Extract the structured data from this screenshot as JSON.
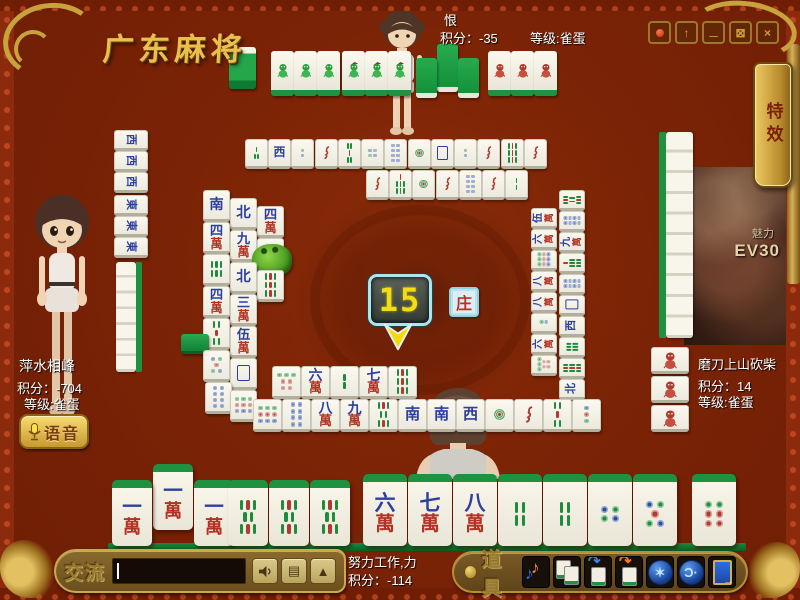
{
  "title": "广东麻将",
  "window_controls": [
    "record",
    "upload",
    "minimize",
    "maximize",
    "close"
  ],
  "effects_tab": "特效",
  "players": {
    "top": {
      "name": "恨",
      "score": "积分：-35",
      "level": "等级:雀蛋"
    },
    "left": {
      "name": "萍水相峰",
      "score": "积分：-704",
      "level": "等级:雀蛋"
    },
    "right": {
      "name": "磨刀上山砍柴",
      "score": "积分：14",
      "level": "等级:雀蛋"
    },
    "bottom": {
      "name": "努力工作,力",
      "score": "积分：-114"
    }
  },
  "voice_button": "语音",
  "chat": {
    "label": "交流",
    "input_value": "",
    "buttons": [
      "speaker",
      "memo",
      "collapse"
    ]
  },
  "props": {
    "label": "道具",
    "icons": [
      "music",
      "tiles",
      "swap-blue",
      "swap-orange",
      "skill",
      "listen",
      "exit"
    ]
  },
  "center": {
    "timer": "15",
    "dealer": "庄"
  },
  "ev_panel": {
    "caption": "魅力",
    "code": "EV30"
  },
  "colors": {
    "table": "#7b2306",
    "gold": "#d7af4a",
    "tile_green": "#1f9242",
    "timer_digits": "#f2dc12",
    "wan_red": "#b23324",
    "char_blue": "#2e3f9f"
  },
  "tiles": [
    [
      229,
      47,
      27,
      42,
      "back",
      "upb",
      0
    ],
    [
      271,
      51,
      23,
      45,
      "sg",
      "up",
      0
    ],
    [
      294,
      51,
      23,
      45,
      "sg",
      "up",
      0
    ],
    [
      317,
      51,
      23,
      45,
      "sg",
      "up",
      0
    ],
    [
      342,
      51,
      23,
      45,
      "sh",
      "up",
      0
    ],
    [
      365,
      51,
      23,
      45,
      "sh",
      "up",
      0
    ],
    [
      388,
      51,
      23,
      45,
      "sh",
      "up",
      0
    ],
    [
      416,
      58,
      21,
      40,
      "",
      "kong",
      0
    ],
    [
      437,
      44,
      21,
      48,
      "",
      "kong",
      0
    ],
    [
      458,
      58,
      21,
      40,
      "",
      "kong",
      0
    ],
    [
      488,
      51,
      23,
      45,
      "sr",
      "up",
      0
    ],
    [
      511,
      51,
      23,
      45,
      "sr",
      "up",
      0
    ],
    [
      534,
      51,
      23,
      45,
      "sr",
      "up",
      0
    ],
    [
      245,
      139,
      23,
      30,
      "b3",
      "flat",
      0
    ],
    [
      268,
      139,
      23,
      30,
      "west",
      "flat",
      0
    ],
    [
      291,
      139,
      23,
      30,
      "c2",
      "flat",
      0
    ],
    [
      315,
      139,
      23,
      30,
      "b1",
      "flat",
      0
    ],
    [
      338,
      139,
      23,
      30,
      "b5",
      "flat",
      0
    ],
    [
      361,
      139,
      23,
      30,
      "c4",
      "flat",
      0
    ],
    [
      384,
      139,
      23,
      30,
      "c8",
      "flat",
      0
    ],
    [
      408,
      139,
      23,
      30,
      "c1",
      "flat",
      0
    ],
    [
      431,
      139,
      23,
      30,
      "white",
      "flat",
      0
    ],
    [
      454,
      139,
      23,
      30,
      "c2",
      "flat",
      0
    ],
    [
      477,
      139,
      23,
      30,
      "b1",
      "flat",
      0
    ],
    [
      501,
      139,
      23,
      30,
      "b9",
      "flat",
      0
    ],
    [
      524,
      139,
      23,
      30,
      "b1",
      "flat",
      0
    ],
    [
      366,
      170,
      23,
      30,
      "b1",
      "flat",
      0
    ],
    [
      389,
      170,
      23,
      30,
      "b7",
      "flat",
      0
    ],
    [
      412,
      170,
      23,
      30,
      "c1",
      "flat",
      0
    ],
    [
      436,
      170,
      23,
      30,
      "b1",
      "flat",
      0
    ],
    [
      459,
      170,
      23,
      30,
      "c8",
      "flat",
      0
    ],
    [
      482,
      170,
      23,
      30,
      "b1",
      "flat",
      0
    ],
    [
      505,
      170,
      23,
      30,
      "b2",
      "flat",
      0
    ],
    [
      114,
      130,
      34,
      21,
      "west",
      "flatL",
      0
    ],
    [
      114,
      151,
      34,
      21,
      "west",
      "flatL",
      0
    ],
    [
      114,
      172,
      34,
      21,
      "west",
      "flatL",
      0
    ],
    [
      114,
      195,
      34,
      21,
      "east",
      "flatL",
      0
    ],
    [
      114,
      216,
      34,
      21,
      "east",
      "flatL",
      0
    ],
    [
      114,
      237,
      34,
      21,
      "east",
      "flatL",
      0
    ],
    [
      181,
      334,
      28,
      20,
      "",
      "backflat",
      0
    ],
    [
      203,
      190,
      27,
      32,
      "south",
      "flat",
      0
    ],
    [
      203,
      222,
      27,
      32,
      "w4",
      "flat",
      0
    ],
    [
      203,
      254,
      27,
      32,
      "b6",
      "flat",
      0
    ],
    [
      203,
      286,
      27,
      32,
      "w4",
      "flat",
      0
    ],
    [
      203,
      318,
      27,
      32,
      "b5",
      "flat",
      0
    ],
    [
      203,
      350,
      27,
      32,
      "c5",
      "flat",
      0
    ],
    [
      205,
      382,
      27,
      32,
      "c8",
      "flat",
      0
    ],
    [
      230,
      198,
      27,
      32,
      "north",
      "flat",
      0
    ],
    [
      230,
      230,
      27,
      32,
      "w9",
      "flat",
      0
    ],
    [
      230,
      262,
      27,
      32,
      "north",
      "flat",
      0
    ],
    [
      230,
      294,
      27,
      32,
      "w3",
      "flat",
      0
    ],
    [
      230,
      326,
      27,
      32,
      "w5",
      "flat",
      0
    ],
    [
      230,
      358,
      27,
      32,
      "white",
      "flat",
      0
    ],
    [
      230,
      390,
      27,
      32,
      "c9",
      "flat",
      0
    ],
    [
      257,
      206,
      27,
      32,
      "w4",
      "flat",
      0
    ],
    [
      257,
      238,
      27,
      32,
      "c6",
      "flat",
      0
    ],
    [
      257,
      270,
      27,
      32,
      "b9",
      "flat",
      0
    ],
    [
      252,
      244,
      40,
      32,
      "",
      "frog",
      0
    ],
    [
      531,
      208,
      26,
      21,
      "w5",
      "flatR",
      0
    ],
    [
      531,
      229,
      26,
      21,
      "w6",
      "flatR",
      0
    ],
    [
      531,
      250,
      26,
      21,
      "c9",
      "flatR",
      0
    ],
    [
      531,
      271,
      26,
      21,
      "w8",
      "flatR",
      0
    ],
    [
      531,
      292,
      26,
      21,
      "w8",
      "flatR",
      0
    ],
    [
      531,
      313,
      26,
      21,
      "c2",
      "flatR",
      0
    ],
    [
      531,
      334,
      26,
      21,
      "w6",
      "flatR",
      0
    ],
    [
      531,
      355,
      26,
      21,
      "c7",
      "flatR",
      0
    ],
    [
      559,
      190,
      26,
      21,
      "b8",
      "flatR",
      0
    ],
    [
      559,
      211,
      26,
      21,
      "c8",
      "flatR",
      0
    ],
    [
      559,
      232,
      26,
      21,
      "w9",
      "flatR",
      0
    ],
    [
      559,
      253,
      26,
      21,
      "b7",
      "flatR",
      0
    ],
    [
      559,
      274,
      26,
      21,
      "c8",
      "flatR",
      0
    ],
    [
      559,
      295,
      26,
      21,
      "white",
      "flatR",
      0
    ],
    [
      559,
      316,
      26,
      21,
      "west",
      "flatR",
      0
    ],
    [
      559,
      337,
      26,
      21,
      "b6",
      "flatR",
      0
    ],
    [
      559,
      358,
      26,
      21,
      "b9",
      "flatR",
      0
    ],
    [
      559,
      379,
      26,
      21,
      "north",
      "flatR",
      0
    ],
    [
      651,
      347,
      38,
      27,
      "sr",
      "flat",
      0
    ],
    [
      651,
      376,
      38,
      27,
      "sr",
      "flat",
      0
    ],
    [
      651,
      405,
      38,
      27,
      "sr",
      "flat",
      0
    ],
    [
      112,
      480,
      40,
      66,
      "w1",
      "stand",
      0
    ],
    [
      153,
      464,
      40,
      66,
      "w1",
      "stand",
      0
    ],
    [
      194,
      480,
      40,
      66,
      "w1",
      "stand",
      0
    ],
    [
      228,
      480,
      40,
      66,
      "b8",
      "stand",
      0
    ],
    [
      269,
      480,
      40,
      66,
      "b8",
      "stand",
      0
    ],
    [
      310,
      480,
      40,
      66,
      "b8",
      "stand",
      0
    ],
    [
      363,
      474,
      44,
      72,
      "w6",
      "stand",
      1
    ],
    [
      408,
      474,
      44,
      72,
      "w7",
      "stand",
      1
    ],
    [
      453,
      474,
      44,
      72,
      "w8",
      "stand",
      1
    ],
    [
      498,
      474,
      44,
      72,
      "b4",
      "stand",
      1
    ],
    [
      543,
      474,
      44,
      72,
      "b4",
      "stand",
      1
    ],
    [
      588,
      474,
      44,
      72,
      "c4",
      "stand",
      1
    ],
    [
      633,
      474,
      44,
      72,
      "c5",
      "stand",
      1
    ],
    [
      692,
      474,
      44,
      72,
      "c6",
      "stand",
      1
    ],
    [
      272,
      366,
      29,
      33,
      "c7",
      "flat",
      0
    ],
    [
      301,
      366,
      29,
      33,
      "w6",
      "flat",
      0
    ],
    [
      330,
      366,
      29,
      33,
      "b2",
      "flat",
      0
    ],
    [
      359,
      366,
      29,
      33,
      "w7",
      "flat",
      0
    ],
    [
      388,
      366,
      29,
      33,
      "b9",
      "flat",
      0
    ],
    [
      253,
      399,
      29,
      33,
      "c9",
      "flat",
      0
    ],
    [
      282,
      399,
      29,
      33,
      "c8",
      "flat",
      0
    ],
    [
      311,
      399,
      29,
      33,
      "w8",
      "flat",
      0
    ],
    [
      340,
      399,
      29,
      33,
      "w9",
      "flat",
      0
    ],
    [
      369,
      399,
      29,
      33,
      "b8",
      "flat",
      0
    ],
    [
      398,
      399,
      29,
      33,
      "south",
      "flat",
      0
    ],
    [
      427,
      399,
      29,
      33,
      "south",
      "flat",
      0
    ],
    [
      456,
      399,
      29,
      33,
      "west",
      "flat",
      0
    ],
    [
      485,
      399,
      29,
      33,
      "c1",
      "flat",
      0
    ],
    [
      514,
      399,
      29,
      33,
      "b1",
      "flat",
      0
    ],
    [
      543,
      399,
      29,
      33,
      "b5",
      "flat",
      0
    ],
    [
      572,
      399,
      29,
      33,
      "c3",
      "flat",
      0
    ]
  ]
}
